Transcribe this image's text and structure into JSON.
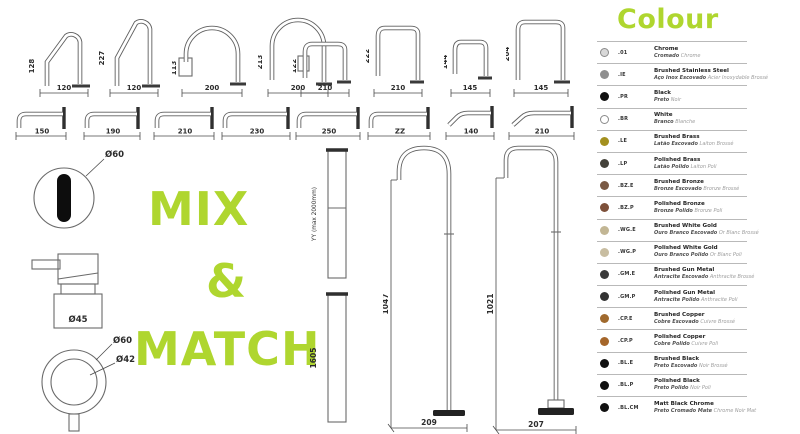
{
  "accent_green": "#afd62f",
  "mix_match": {
    "line1": "MIX",
    "line2": "&",
    "line3": "MATCH"
  },
  "top_spouts": [
    {
      "height_label": "128",
      "width_label": "120"
    },
    {
      "height_label": "227",
      "width_label": "120"
    },
    {
      "height_label": "113",
      "width_label": "200"
    },
    {
      "height_label": "213",
      "width_label": "200"
    },
    {
      "height_label": "122",
      "width_label": "210"
    },
    {
      "height_label": "222",
      "width_label": "210"
    },
    {
      "height_label": "144",
      "width_label": "145"
    },
    {
      "height_label": "204",
      "width_label": "145"
    }
  ],
  "wall_spouts": [
    {
      "length_label": "150"
    },
    {
      "length_label": "190"
    },
    {
      "length_label": "210"
    },
    {
      "length_label": "230"
    },
    {
      "length_label": "250"
    },
    {
      "length_label": "ZZ"
    },
    {
      "length_label": "140"
    },
    {
      "length_label": "210"
    }
  ],
  "left_diagrams": {
    "sensor_diameter": "Ø60",
    "mixer_diameter": "Ø45",
    "handle_outer_diameter": "Ø60",
    "handle_inner_diameter": "Ø42"
  },
  "columns": [
    {
      "label": "YY (max 2000mm)"
    },
    {
      "label": "1605"
    }
  ],
  "floor_spouts": [
    {
      "height_label": "1047",
      "base_label": "209"
    },
    {
      "height_label": "1021",
      "base_label": "207"
    }
  ],
  "colour_legend": {
    "title": "Colour",
    "entries": [
      {
        "code": ".01",
        "name": "Chrome",
        "pt": "Cromado",
        "fr": "Chrome",
        "swatch": "#d8d8d8",
        "outline": true
      },
      {
        "code": ".IE",
        "name": "Brushed Stainless Steel",
        "pt": "Aço Inox Escovado",
        "fr": "Acier Inoxydable Brossé",
        "swatch": "#8f8f8f",
        "outline": false
      },
      {
        "code": ".PR",
        "name": "Black",
        "pt": "Preto",
        "fr": "Noir",
        "swatch": "#111111",
        "outline": false
      },
      {
        "code": ".BR",
        "name": "White",
        "pt": "Branco",
        "fr": "Blanche",
        "swatch": "#ffffff",
        "outline": true
      },
      {
        "code": ".LE",
        "name": "Brushed Brass",
        "pt": "Latão Escovado",
        "fr": "Laiton Brossé",
        "swatch": "#a3901f",
        "outline": false
      },
      {
        "code": ".LP",
        "name": "Polished Brass",
        "pt": "Latão Polido",
        "fr": "Laiton Poli",
        "swatch": "#44423a",
        "outline": false
      },
      {
        "code": ".BZ.E",
        "name": "Brushed Bronze",
        "pt": "Bronze Escovado",
        "fr": "Bronze Brossé",
        "swatch": "#7a5a45",
        "outline": false
      },
      {
        "code": ".BZ.P",
        "name": "Polished Bronze",
        "pt": "Bronze Polido",
        "fr": "Bronze Poli",
        "swatch": "#7d503a",
        "outline": false
      },
      {
        "code": ".WG.E",
        "name": "Brushed White Gold",
        "pt": "Ouro Branco Escovado",
        "fr": "Or Blanc Brossé",
        "swatch": "#c2b694",
        "outline": false
      },
      {
        "code": ".WG.P",
        "name": "Polished White Gold",
        "pt": "Ouro Branco Polido",
        "fr": "Or Blanc Poli",
        "swatch": "#c8bda1",
        "outline": false
      },
      {
        "code": ".GM.E",
        "name": "Brushed Gun Metal",
        "pt": "Antracite Escovado",
        "fr": "Anthracite Brossé",
        "swatch": "#3b3b3b",
        "outline": false
      },
      {
        "code": ".GM.P",
        "name": "Polished Gun Metal",
        "pt": "Antracite Polido",
        "fr": "Anthracite Poli",
        "swatch": "#343434",
        "outline": false
      },
      {
        "code": ".CP.E",
        "name": "Brushed Copper",
        "pt": "Cobre Escovado",
        "fr": "Cuivre Brossé",
        "swatch": "#a06a2e",
        "outline": false
      },
      {
        "code": ".CP.P",
        "name": "Polished Copper",
        "pt": "Cobre Polido",
        "fr": "Cuivre Poli",
        "swatch": "#a5662a",
        "outline": false
      },
      {
        "code": ".BL.E",
        "name": "Brushed Black",
        "pt": "Preto Escovado",
        "fr": "Noir Brossé",
        "swatch": "#111111",
        "outline": false
      },
      {
        "code": ".BL.P",
        "name": "Polished Black",
        "pt": "Preto Polido",
        "fr": "Noir Poli",
        "swatch": "#111111",
        "outline": false
      },
      {
        "code": ".BL.CM",
        "name": "Matt Black Chrome",
        "pt": "Preto Cromado Mate",
        "fr": "Chrome Noir Mat",
        "swatch": "#111111",
        "outline": false
      }
    ]
  }
}
